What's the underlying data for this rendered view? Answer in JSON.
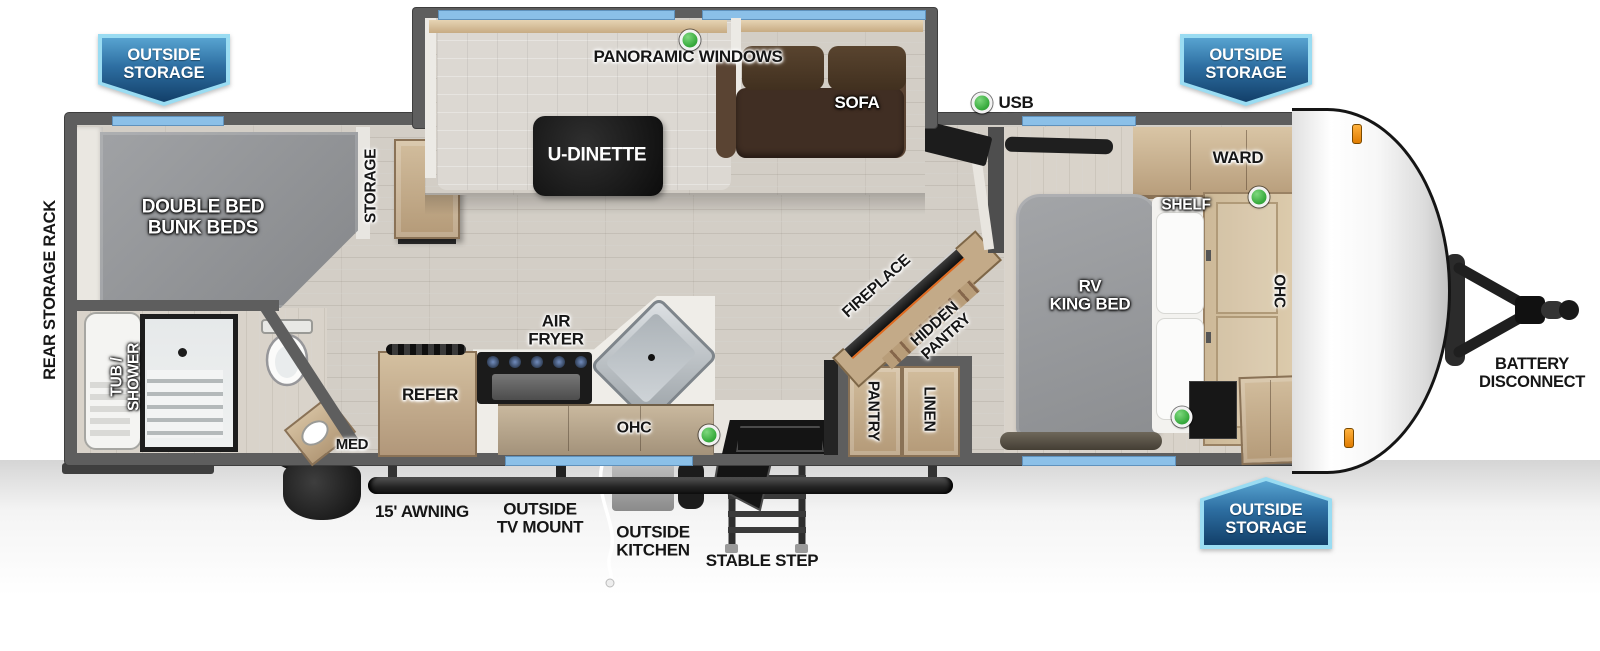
{
  "title": "Travel trailer floorplan",
  "colors": {
    "wall": "#5e5e5e",
    "window_blue": "#8bc0e8",
    "usb_green": "#38ab3e",
    "badge_blue_dark": "#123f69",
    "badge_blue_light": "#57a3d0",
    "badge_border": "#9adcf2",
    "wood": "#c9b393",
    "bed_gray": "#97999c",
    "sofa_brown": "#46332a"
  },
  "badges": [
    {
      "id": "top-left",
      "label": "OUTSIDE STORAGE"
    },
    {
      "id": "top-right",
      "label": "OUTSIDE STORAGE"
    },
    {
      "id": "bottom-right",
      "label": "OUTSIDE STORAGE"
    }
  ],
  "slideout": {
    "windows_label": "PANORAMIC WINDOWS",
    "dinette_label": "U-DINETTE",
    "sofa_label": "SOFA"
  },
  "living": {
    "usb_label": "USB",
    "fireplace_label": "FIREPLACE",
    "hidden_pantry_label": "HIDDEN\nPANTRY",
    "pantry_label": "PANTRY",
    "linen_label": "LINEN"
  },
  "kitchen": {
    "refer_label": "REFER",
    "air_fryer_label": "AIR\nFRYER",
    "ohc_label": "OHC"
  },
  "bedroom": {
    "ward_label": "WARD",
    "shelf_label": "SHELF",
    "bed_label": "RV\nKING BED",
    "ohc_label": "OHC"
  },
  "bunk_room": {
    "bed_label": "DOUBLE BED\nBUNK BEDS",
    "storage_label": "STORAGE"
  },
  "bathroom": {
    "tub_shower_label": "TUB /\nSHOWER",
    "med_label": "MED"
  },
  "exterior": {
    "rear_rack_label": "REAR STORAGE RACK",
    "awning_label": "15' AWNING",
    "tv_mount_label": "OUTSIDE\nTV MOUNT",
    "outside_kitchen_label": "OUTSIDE\nKITCHEN",
    "step_label": "STABLE STEP",
    "battery_label": "BATTERY\nDISCONNECT"
  }
}
